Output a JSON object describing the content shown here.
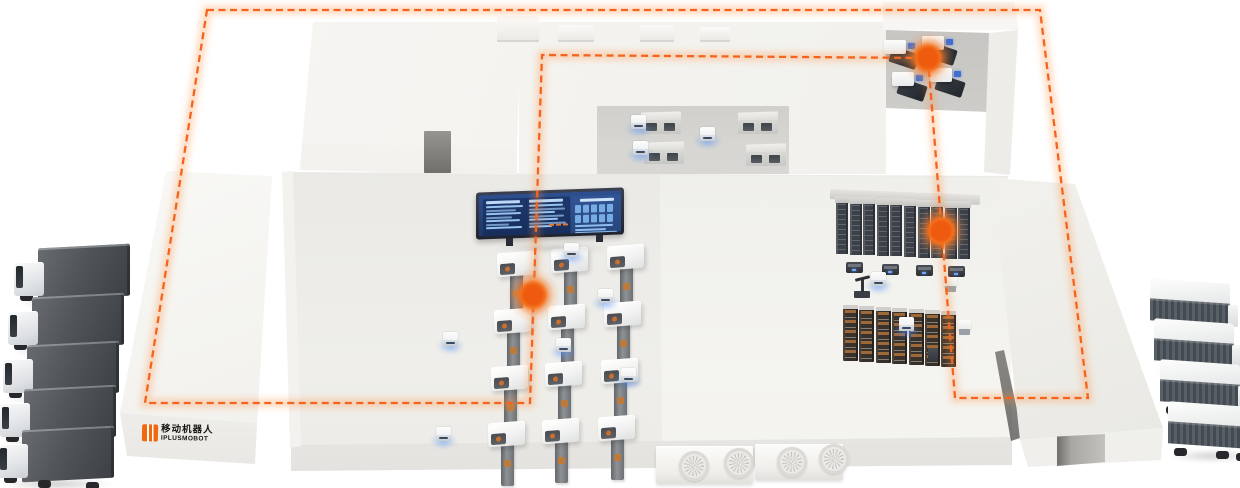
{
  "scene": {
    "bg": "#ffffff",
    "accent": "#f4641e",
    "accent_glow": "#ff8a3c",
    "agv_glow": "#5b93f5",
    "building": "#f4f3f0",
    "floor": "#ebeae6"
  },
  "logo": {
    "line1": "移动机器人",
    "line2": "IPLUSMOBOT",
    "mark_color": "#f0690f",
    "text_color": "#17150f"
  },
  "route": {
    "dash": "7 4.5",
    "width": 2.3,
    "loop": [
      [
        207,
        10
      ],
      [
        1040,
        10
      ],
      [
        1088,
        398
      ],
      [
        955,
        398
      ],
      [
        928,
        58
      ],
      [
        542,
        55
      ],
      [
        530,
        403
      ],
      [
        145,
        403
      ]
    ],
    "waypoints": [
      [
        928,
        58
      ],
      [
        941,
        231
      ],
      [
        533,
        295
      ]
    ]
  },
  "fleet": {
    "left_trucks": [
      [
        14,
        246
      ],
      [
        8,
        295
      ],
      [
        3,
        343
      ],
      [
        0,
        387
      ],
      [
        -2,
        428
      ]
    ],
    "right_trucks": [
      [
        1150,
        279
      ],
      [
        1154,
        319
      ],
      [
        1160,
        360
      ],
      [
        1168,
        402
      ]
    ]
  },
  "machining": {
    "cnc": [
      [
        497,
        252
      ],
      [
        494,
        309
      ],
      [
        491,
        366
      ],
      [
        488,
        422
      ],
      [
        551,
        248
      ],
      [
        548,
        305
      ],
      [
        545,
        362
      ],
      [
        542,
        419
      ],
      [
        607,
        245
      ],
      [
        604,
        302
      ],
      [
        601,
        359
      ],
      [
        598,
        416
      ]
    ]
  },
  "agvs": {
    "floor": [
      [
        443,
        332
      ],
      [
        564,
        243
      ],
      [
        598,
        289
      ],
      [
        556,
        338
      ],
      [
        621,
        368
      ],
      [
        436,
        427
      ]
    ],
    "mezzanine": [
      [
        631,
        115
      ],
      [
        700,
        127
      ],
      [
        633,
        141
      ]
    ],
    "right_zone": [
      [
        871,
        272
      ],
      [
        899,
        317
      ]
    ]
  },
  "mezzanine": {
    "cabinets": [
      [
        641,
        112
      ],
      [
        738,
        112
      ],
      [
        644,
        142
      ],
      [
        746,
        144
      ]
    ]
  },
  "upper_room": {
    "presses": [
      [
        884,
        40
      ],
      [
        922,
        36
      ],
      [
        892,
        72
      ],
      [
        930,
        68
      ]
    ]
  },
  "storage": {
    "beam": {
      "x": 830,
      "y": 192
    },
    "tower_row": {
      "x": 836,
      "y": 202,
      "count": 10,
      "step": 13.6,
      "rise": 0.6
    },
    "pallet_racks": {
      "x": 843,
      "y": 305,
      "count": 7,
      "step": 16.4,
      "rise": 1.0
    },
    "dock_shuttles": [
      [
        846,
        262
      ],
      [
        882,
        264
      ],
      [
        916,
        265
      ],
      [
        948,
        266
      ]
    ],
    "white_shuttles": [
      [
        944,
        277
      ],
      [
        958,
        320
      ]
    ],
    "dark_units": [
      [
        928,
        348
      ]
    ],
    "arm_robot": [
      852,
      276
    ]
  },
  "rooftop_units": [
    [
      497,
      16,
      42,
      24
    ],
    [
      558,
      25,
      36,
      15
    ],
    [
      640,
      25,
      34,
      15
    ],
    [
      700,
      27,
      30,
      13
    ]
  ],
  "vents": [
    {
      "x": 656,
      "y": 446,
      "w": 97,
      "h": 38,
      "fans": [
        [
          38,
          20
        ],
        [
          83,
          17
        ]
      ]
    },
    {
      "x": 755,
      "y": 444,
      "w": 88,
      "h": 36,
      "fans": [
        [
          37,
          18
        ],
        [
          79,
          15
        ]
      ]
    }
  ],
  "display": {
    "x": 476,
    "y": 190,
    "w": 148,
    "h": 47,
    "left_rows_a": [
      92,
      74,
      88,
      66,
      84,
      58,
      90
    ],
    "left_rows_b": [
      84,
      90,
      64,
      88,
      72,
      92,
      58
    ],
    "right_blocks": [
      5,
      5
    ],
    "right_bars": [
      80,
      65,
      88
    ],
    "ticks": [
      70,
      77,
      84
    ],
    "bar_color": "#98c3ef",
    "block_color": "#76abe4",
    "tick_color": "#e0762f",
    "frame": "#262b38"
  }
}
